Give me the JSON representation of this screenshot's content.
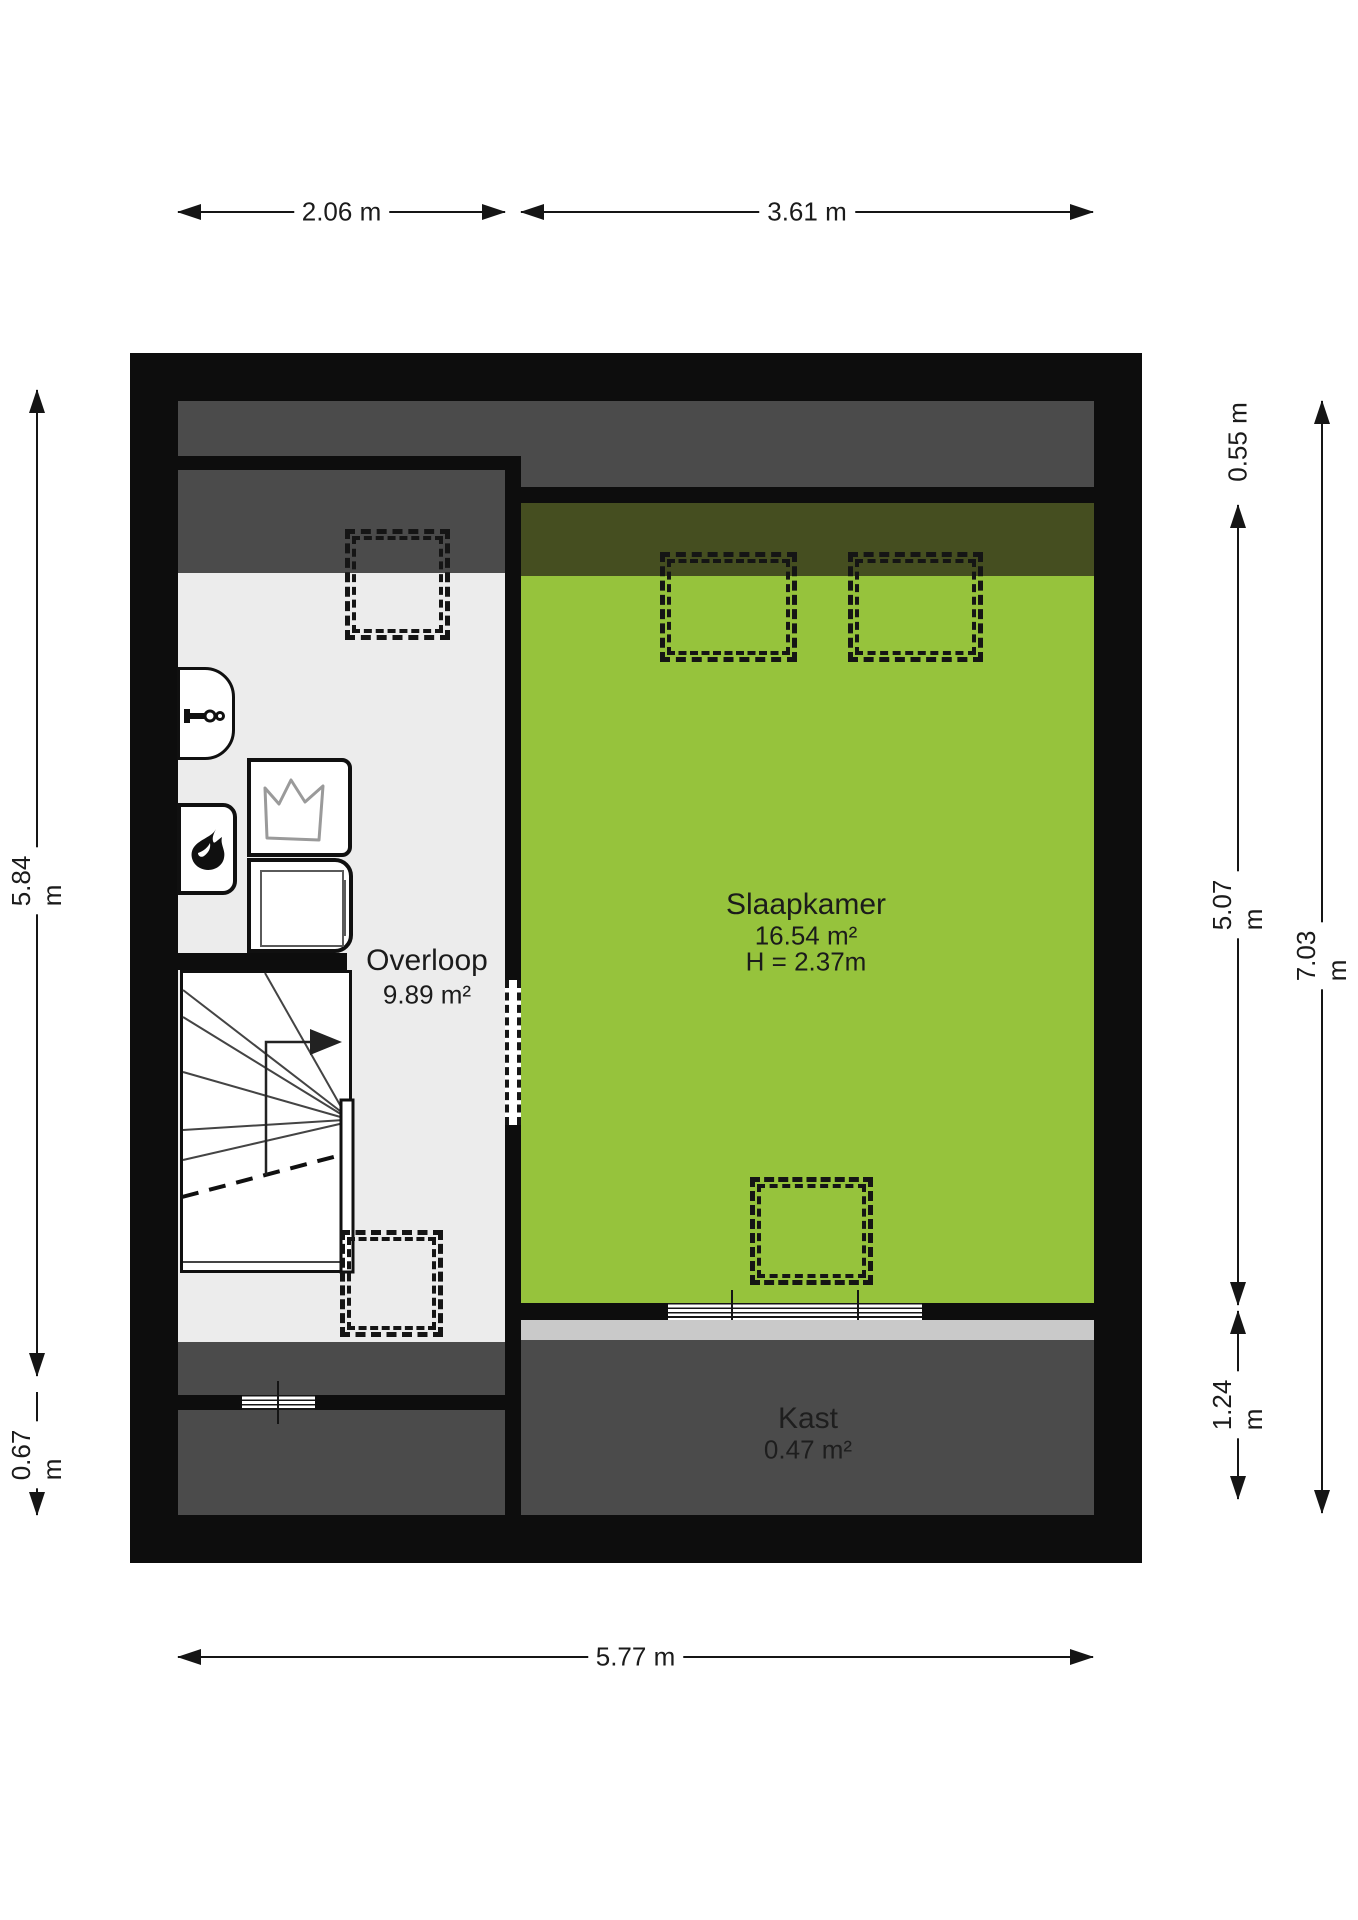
{
  "rooms": {
    "overloop": {
      "name": "Overloop",
      "area": "9.89 m²"
    },
    "slaapkamer": {
      "name": "Slaapkamer",
      "area": "16.54 m²",
      "height": "H = 2.37m"
    },
    "kast": {
      "name": "Kast",
      "area": "0.47 m²"
    }
  },
  "dimensions": {
    "top_left": "2.06 m",
    "top_right": "3.61 m",
    "bottom": "5.77 m",
    "left_main": "5.84 m",
    "left_small": "0.67 m",
    "right_top": "0.55 m",
    "right_middle": "5.07 m",
    "right_bottom": "1.24 m",
    "right_overall": "7.03 m"
  },
  "colors": {
    "green": "#96c33c",
    "green_dark": "#454e20",
    "gray_dark": "#4b4b4b",
    "gray_light": "#ececec",
    "gray_sill": "#c9c9c9",
    "wall": "#0d0d0d",
    "ink": "#151515"
  }
}
